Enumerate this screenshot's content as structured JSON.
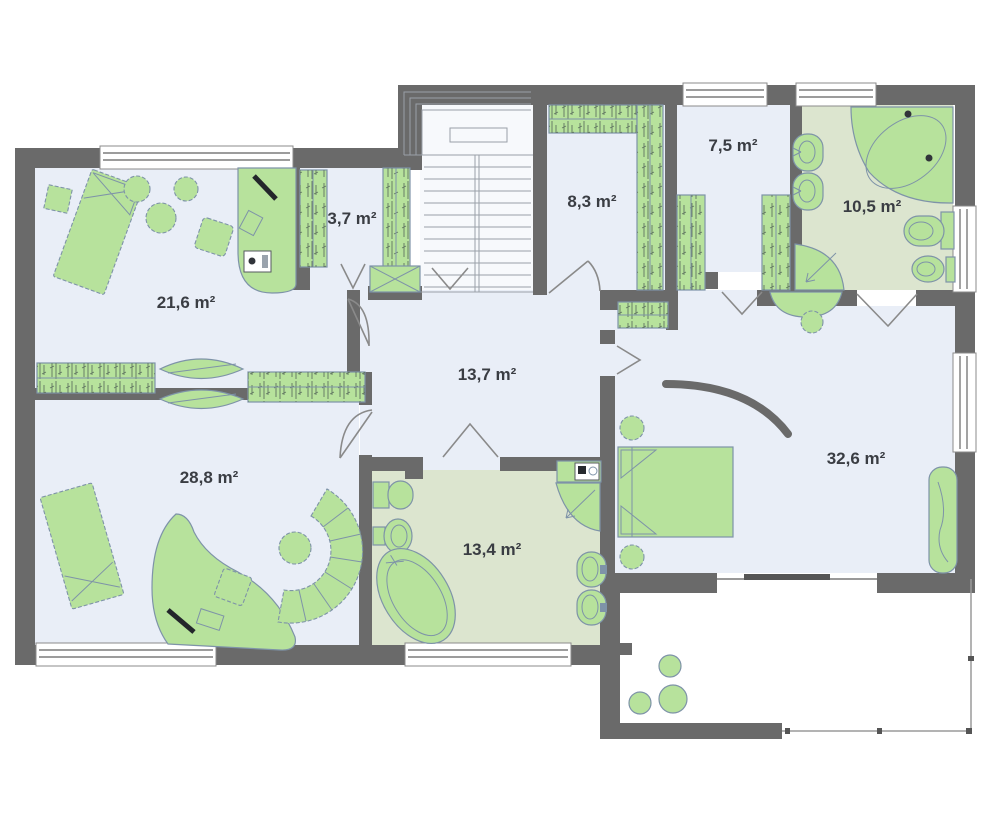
{
  "plan": {
    "type": "floor-plan-upper-storey",
    "rooms": [
      {
        "id": "room-top-left",
        "label": "21,6 m²"
      },
      {
        "id": "closet-small",
        "label": "3,7 m²"
      },
      {
        "id": "walkin-closet",
        "label": "8,3 m²"
      },
      {
        "id": "closet-mid",
        "label": "7,5 m²"
      },
      {
        "id": "bathroom-top",
        "label": "10,5 m²"
      },
      {
        "id": "hall",
        "label": "13,7 m²"
      },
      {
        "id": "room-bottom-left",
        "label": "28,8 m²"
      },
      {
        "id": "bathroom-main",
        "label": "13,4 m²"
      },
      {
        "id": "master-bedroom",
        "label": "32,6 m²"
      }
    ],
    "colors": {
      "wall": "#6a6a6a",
      "room_floor": "#e9eef7",
      "stair_floor": "#f7f9fc",
      "bath_floor": "#dce5cf",
      "terrace_floor": "#ffffff",
      "furniture": "#b7e29c",
      "furniture_stroke": "#7e93a8",
      "window": "#ffffff",
      "door": "#8a8a8a",
      "label": "#3a3d43"
    }
  }
}
